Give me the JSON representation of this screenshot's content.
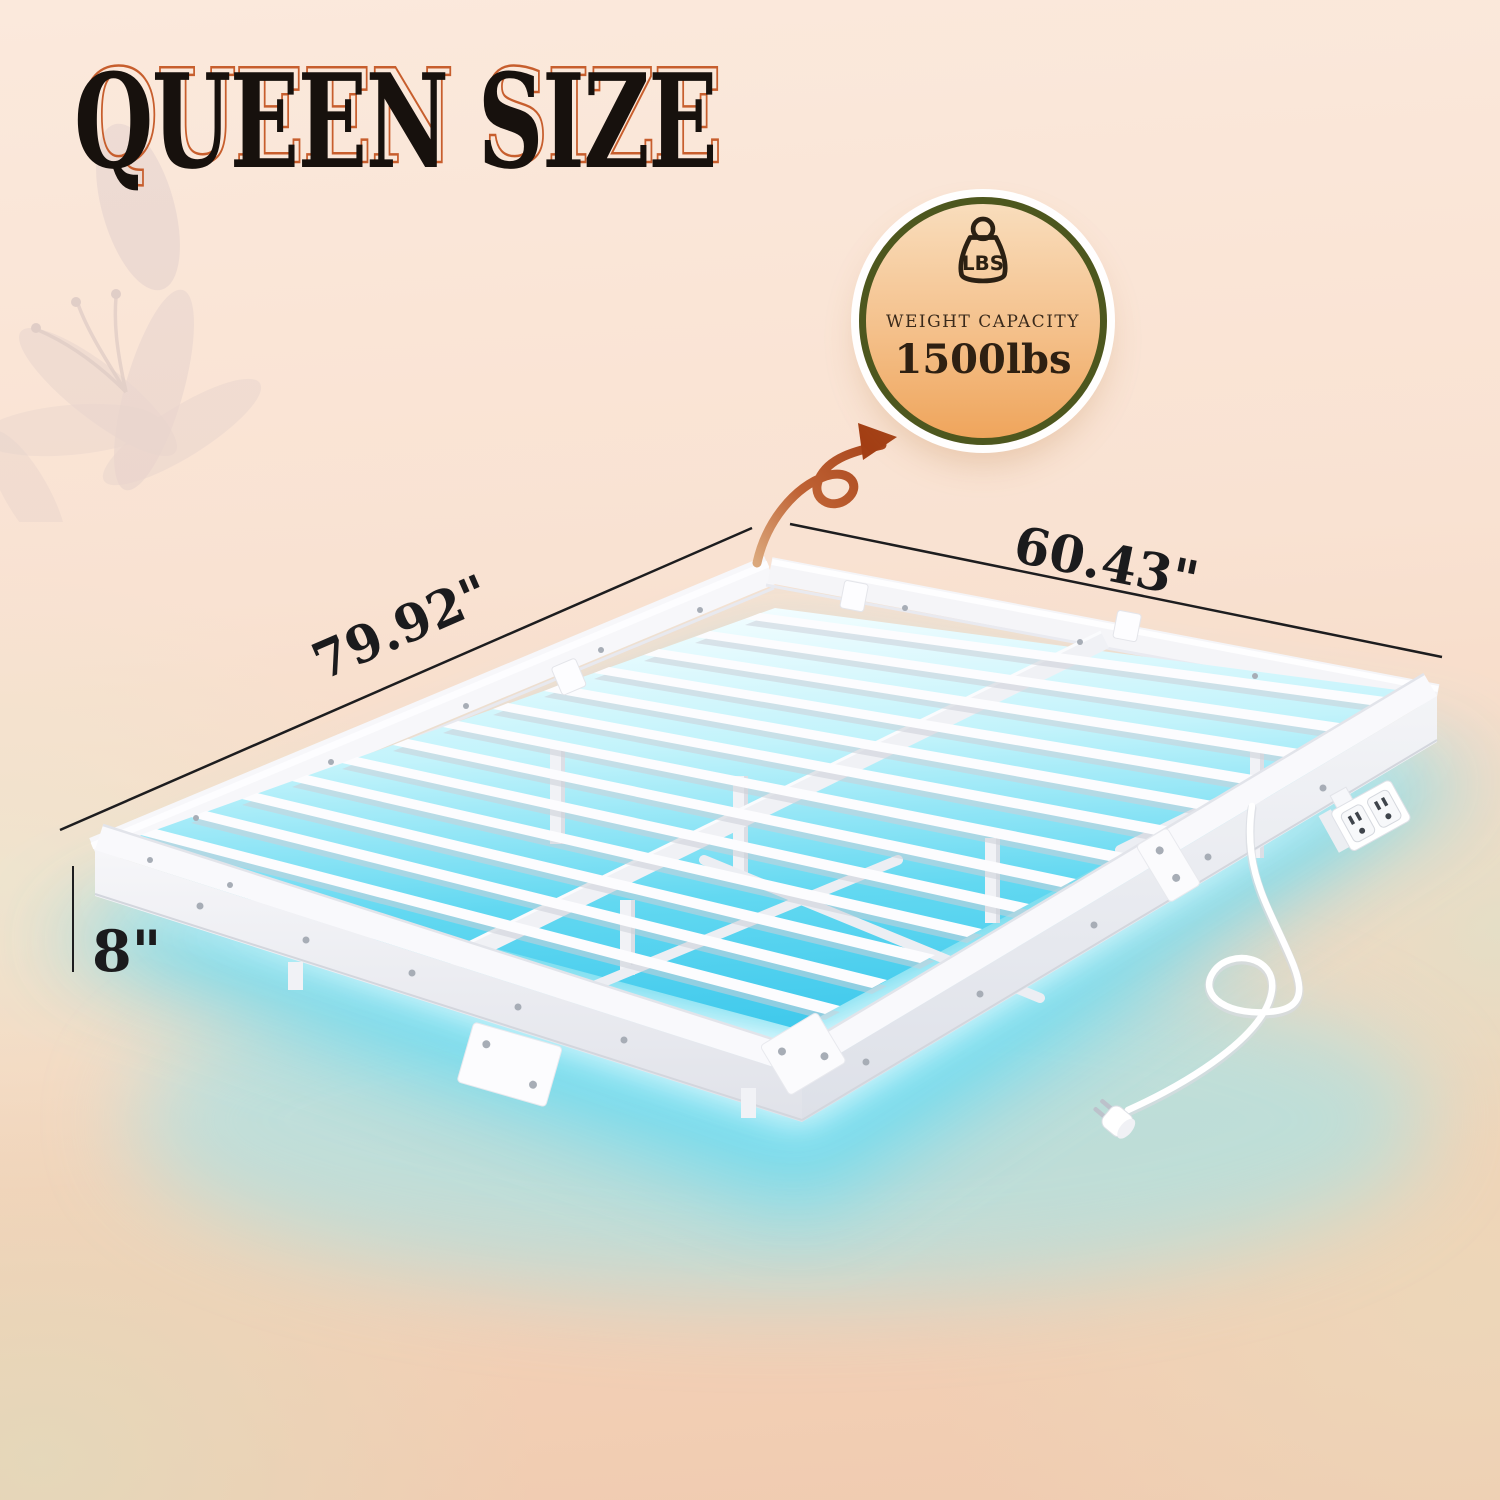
{
  "title": "QUEEN SIZE",
  "badge": {
    "icon_label": "LBS",
    "caption": "WEIGHT CAPACITY",
    "value": "1500lbs"
  },
  "dimensions": {
    "length": "79.92\"",
    "width": "60.43\"",
    "height": "8\""
  },
  "icons": {
    "weight_icon": "kettlebell weight with LBS label",
    "arrow_icon": "curled brush arrow pointing to badge",
    "flower_watermark": "faint lily flower",
    "power_outlet": "dual outlet unit on bed rail",
    "power_plug": "two-prong plug on cord"
  },
  "colors": {
    "led_glow_cyan": "#5bd7f0",
    "badge_ring_green": "#4d571e",
    "badge_gradient_top": "#f9ddbc",
    "badge_gradient_bottom": "#efa55c",
    "arrow_rust": "#a8451a",
    "title_black": "#17110d",
    "title_outline_orange": "#c75e2d",
    "background_peach": "#f8e2d1",
    "frame_white": "#f7f7fa"
  }
}
